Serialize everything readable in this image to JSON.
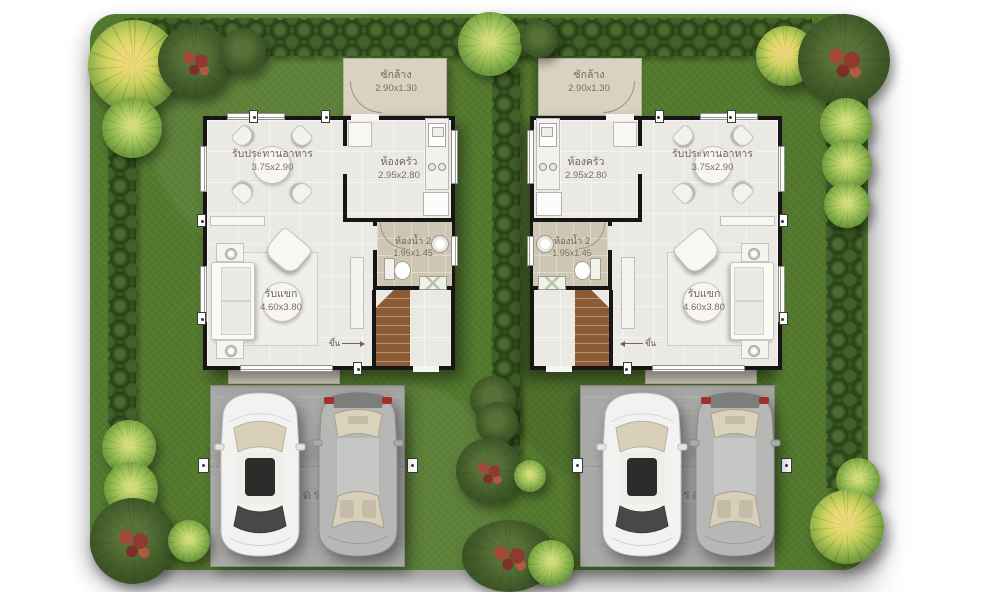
{
  "plan": {
    "houses": [
      {
        "id": "left",
        "rooms": {
          "laundry": {
            "name": "ซักล้าง",
            "size": "2.90x1.30"
          },
          "dining": {
            "name": "รับประทานอาหาร",
            "size": "3.75x2.90"
          },
          "kitchen": {
            "name": "ห้องครัว",
            "size": "2.95x2.80"
          },
          "bathroom": {
            "name": "ห้องน้ำ 2",
            "size": "1.95x1.45"
          },
          "living": {
            "name": "รับแขก",
            "size": "4.60x3.80"
          }
        },
        "stairs_label": "ขึ้น",
        "parking_label": "จอดรถ"
      },
      {
        "id": "right",
        "rooms": {
          "laundry": {
            "name": "ซักล้าง",
            "size": "2.90x1.30"
          },
          "dining": {
            "name": "รับประทานอาหาร",
            "size": "3.75x2.90"
          },
          "kitchen": {
            "name": "ห้องครัว",
            "size": "2.95x2.80"
          },
          "bathroom": {
            "name": "ห้องน้ำ 2",
            "size": "1.95x1.45"
          },
          "living": {
            "name": "รับแขก",
            "size": "4.60x3.80"
          }
        },
        "stairs_label": "ขึ้น",
        "parking_label": "จอดรถ"
      }
    ],
    "colors": {
      "lawn": "#547a2e",
      "hedge": "#35511f",
      "floor": "#ebe9e3",
      "wall": "#161616",
      "bathroom_floor": "#cfc5b3",
      "laundry_pad": "#d9d2c1",
      "parking_pad": "#a8a8a6",
      "stairs": "#8a5b35",
      "car_white": "#f2f2f0",
      "car_silver": "#b9b9b7",
      "flower": "#8e3a31",
      "label_text": "#6e665b"
    }
  }
}
